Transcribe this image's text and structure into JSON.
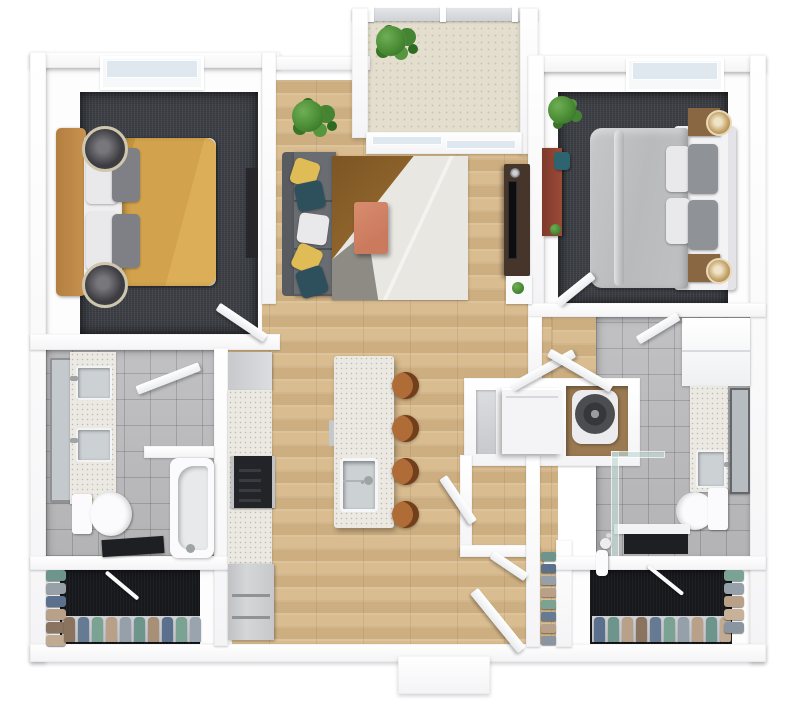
{
  "scene": {
    "type": "apartment-floor-plan-3d-top-view",
    "rooms": [
      "bedroom-1",
      "living-room",
      "balcony",
      "bedroom-2",
      "bathroom-1",
      "kitchen",
      "laundry-closet",
      "pantry",
      "bathroom-2",
      "walk-in-closet-1",
      "walk-in-closet-2",
      "entry"
    ],
    "furniture": [
      "queen-bed-yellow",
      "queen-bed-gray",
      "sofa",
      "area-rug",
      "coffee-table",
      "tv-console",
      "desk",
      "kitchen-island",
      "bar-stools",
      "washer",
      "dryer",
      "bathtub",
      "shower",
      "double-vanity",
      "vanity",
      "toilets",
      "refrigerator",
      "stove",
      "hanging-clothes",
      "shoe-rack",
      "plants"
    ]
  },
  "colors": {
    "wall": "#ffffff",
    "wood": "#d9bc8f",
    "carpet": "#3e4147",
    "carpet_dark": "#17181c",
    "tile": "#bdbdbf",
    "balcony": "#e4decf",
    "counter": "#ebe9e2",
    "stainless": "#c9ccce",
    "stainless2": "#ccd1d4",
    "sofa": "#696c71",
    "sofa_back": "#585b60",
    "pillow_yellow": "#dfbc55",
    "pillow_teal": "#2e4f5c",
    "pillow_white": "#e9e9eb",
    "pillow_gray": "#8f9296",
    "mattress": "#efefef",
    "bed1_duvet": "#d2a24c",
    "bed1_frame": "#c8924f",
    "bed2_duvet": "#b9babc",
    "bed2_frame": "#f3f3f5",
    "nightstand_dark": "#3c3c41",
    "nightstand_ring": "#cfc6ae",
    "nightstand_brown": "#8a6743",
    "lamp_gold": "#c2a065",
    "rug_base": "#e9e7e2",
    "rug_brown": "#9b6d30",
    "rug_gray": "#8e8b85",
    "coffee_table": "#cb7a5e",
    "tv_console": "#45352b",
    "desk_red": "#9c4a38",
    "chair_teal": "#2e6470",
    "stool": "#b06c36",
    "stool_back": "#713f1c",
    "plant": "#4a8c34",
    "plant_dark": "#2f6a22",
    "window_glass": "#dfe8ee",
    "washer": "#f4f4f6",
    "dryer_drum": "#4c4d51",
    "appliance": "#d4d6d8",
    "stove": "#232428",
    "mat": "#1e1f23",
    "laundry_floor": "#9b7a52"
  },
  "closet1": {
    "left_items": [
      "#6d958c",
      "#97a0a8",
      "#5a708c",
      "#b9a089",
      "#8a7460",
      "#c0aa92"
    ],
    "bottom_items": [
      "#8a7460",
      "#667a93",
      "#7aa393",
      "#b9a089",
      "#95a0aa",
      "#6d958c",
      "#a78f78",
      "#5a708c",
      "#7aa393",
      "#9aa4ae"
    ]
  },
  "closet2": {
    "right_items": [
      "#7aa393",
      "#95a0aa",
      "#b9a089",
      "#c7b299",
      "#8a95a0"
    ],
    "bottom_items": [
      "#5a708c",
      "#6d958c",
      "#b9a089",
      "#8a7460",
      "#667a93",
      "#7aa393",
      "#95a0aa",
      "#b9a089",
      "#6d958c",
      "#c0aa92"
    ]
  },
  "shoe_rack": {
    "items": [
      "#6d958c",
      "#5a708c",
      "#97a0a8",
      "#b9a089",
      "#7aa393",
      "#667a93",
      "#b9a089",
      "#8a95a0"
    ]
  },
  "island": {
    "stools": [
      "#b06c36",
      "#b06c36",
      "#b06c36",
      "#b06c36"
    ]
  }
}
